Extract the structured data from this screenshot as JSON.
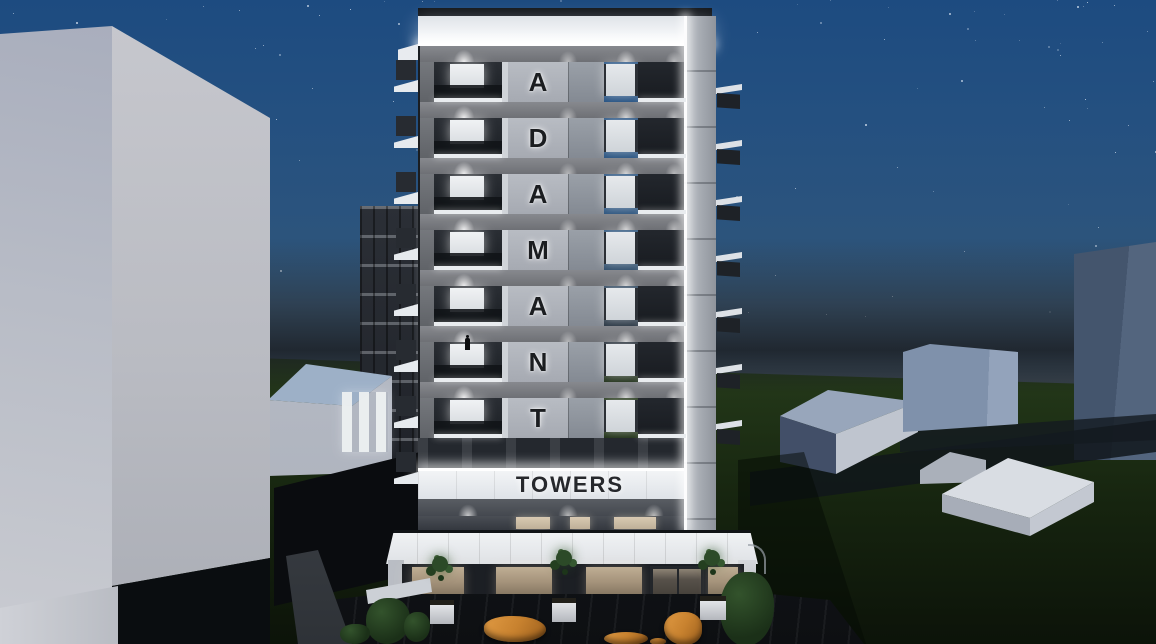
{
  "scene": {
    "type": "architectural-night-render",
    "tower": {
      "vertical_letters": [
        "A",
        "D",
        "A",
        "M",
        "A",
        "N",
        "T"
      ],
      "sign_text": "TOWERS",
      "letter_floor_count": 7,
      "left_balcony_count": 8,
      "side_balcony_count": 7,
      "has_person_on_balcony": true
    },
    "sky": {
      "star_count": 120,
      "top": "#1d4b80",
      "mid": "#2f5579",
      "haze": "#3a454f",
      "dark_band": "#232830"
    },
    "ground": {
      "grass": "#223618",
      "grass_dark": "#0c1309",
      "pavement": "#1a1d22"
    },
    "lighting": {
      "led_strip": "#ffffff",
      "window_cool": "#e9ecef",
      "window_warm": "#d8c9b2",
      "storefront_wood": "#a5937b"
    },
    "palette": {
      "facade_white": "#eef0f3",
      "spandrel_gray": "#787a7f",
      "letter_panel": "#b8bcc3",
      "letter_ink": "#1b1d20",
      "balcony_glass": "#20242a",
      "pillar_light": "#c3c7cd",
      "bench_orange": "#c8822f",
      "foliage": "#2c4a28",
      "massing_light": "#c5c7cd",
      "massing_shadow": "#a9aebd",
      "distant_blue": "#44556d",
      "roof_blue": "#9db0c7"
    }
  }
}
